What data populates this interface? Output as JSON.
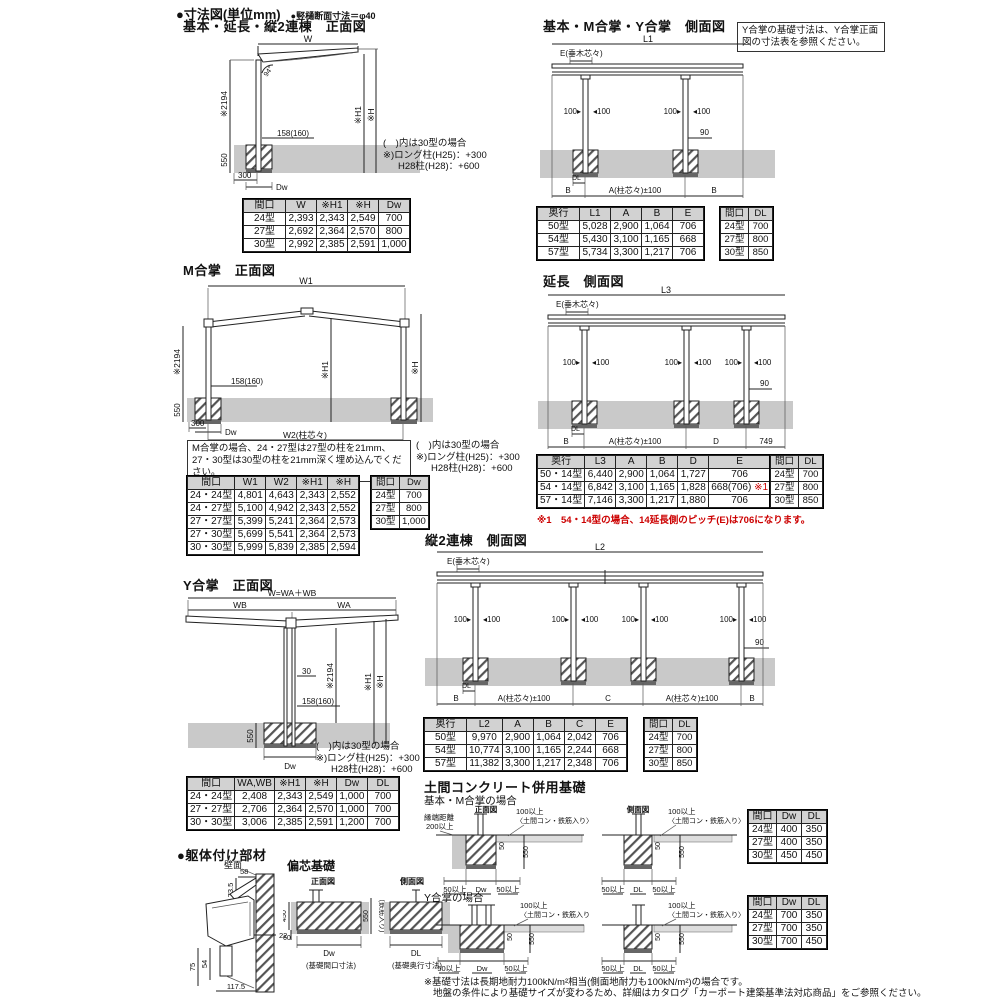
{
  "header": {
    "title": "●寸法図(単位mm)",
    "subtitle": "●竪樋断面寸法＝φ40"
  },
  "common_notes": {
    "l1": "(　)内は30型の場合",
    "l2": "※)ロング柱(H25)：+300",
    "l3": "H28柱(H28)：+600"
  },
  "side_dims": {
    "pl": "100▸",
    "pr": "◂100"
  },
  "front_basic": {
    "title": "基本・延長・縦2連棟　正面図",
    "dims": {
      "w": "W",
      "v2194": "※2194",
      "h1": "※H1",
      "h": "※H",
      "embed": "158(160)",
      "d550": "550",
      "d300": "300",
      "dw": "Dw",
      "angle": "94°"
    },
    "table": {
      "headers": [
        "間口",
        "W",
        "※H1",
        "※H",
        "Dw"
      ],
      "rows": [
        [
          "24型",
          "2,393",
          "2,343",
          "2,549",
          "700"
        ],
        [
          "27型",
          "2,692",
          "2,364",
          "2,570",
          "800"
        ],
        [
          "30型",
          "2,992",
          "2,385",
          "2,591",
          "1,000"
        ]
      ]
    }
  },
  "m_gassho": {
    "title": "M合掌　正面図",
    "note_box": "M合掌の場合、24・27型は27型の柱を21mm、27・30型は30型の柱を21mm深く埋め込んでください。",
    "dims": {
      "w1": "W1",
      "w2": "W2(柱芯々)",
      "v2194": "※2194",
      "h1": "※H1",
      "h": "※H",
      "embed": "158(160)",
      "d550": "550",
      "d300": "300",
      "dw": "Dw"
    },
    "table": {
      "headers": [
        "間口",
        "W1",
        "W2",
        "※H1",
        "※H"
      ],
      "rows": [
        [
          "24・24型",
          "4,801",
          "4,643",
          "2,343",
          "2,552"
        ],
        [
          "24・27型",
          "5,100",
          "4,942",
          "2,343",
          "2,552"
        ],
        [
          "27・27型",
          "5,399",
          "5,241",
          "2,364",
          "2,573"
        ],
        [
          "27・30型",
          "5,699",
          "5,541",
          "2,364",
          "2,573"
        ],
        [
          "30・30型",
          "5,999",
          "5,839",
          "2,385",
          "2,594"
        ]
      ]
    },
    "side_table": {
      "headers": [
        "間口",
        "Dw"
      ],
      "rows": [
        [
          "24型",
          "700"
        ],
        [
          "27型",
          "800"
        ],
        [
          "30型",
          "1,000"
        ]
      ]
    }
  },
  "y_gassho": {
    "title": "Y合掌　正面図",
    "dims": {
      "w": "W=WA＋WB",
      "wb": "WB",
      "wa": "WA",
      "n30": "30",
      "v2194": "※2194",
      "h1": "※H1",
      "h": "※H",
      "embed": "158(160)",
      "d550": "550",
      "dw": "Dw"
    },
    "table": {
      "headers": [
        "間口",
        "WA,WB",
        "※H1",
        "※H",
        "Dw",
        "DL"
      ],
      "rows": [
        [
          "24・24型",
          "2,408",
          "2,343",
          "2,549",
          "1,000",
          "700"
        ],
        [
          "27・27型",
          "2,706",
          "2,364",
          "2,570",
          "1,000",
          "700"
        ],
        [
          "30・30型",
          "3,006",
          "2,385",
          "2,591",
          "1,200",
          "700"
        ]
      ]
    }
  },
  "side_basic": {
    "title": "基本・M合掌・Y合掌　側面図",
    "note_box": "Y合掌の基礎寸法は、Y合掌正面図の寸法表を参照ください。",
    "dims": {
      "l1": "L1",
      "e": "E(垂木芯々)",
      "n90": "90",
      "dl": "DL",
      "b": "B",
      "a": "A(柱芯々)±100"
    },
    "table": {
      "headers": [
        "奥行",
        "L1",
        "A",
        "B",
        "E"
      ],
      "rows": [
        [
          "50型",
          "5,028",
          "2,900",
          "1,064",
          "706"
        ],
        [
          "54型",
          "5,430",
          "3,100",
          "1,165",
          "668"
        ],
        [
          "57型",
          "5,734",
          "3,300",
          "1,217",
          "706"
        ]
      ]
    },
    "side_table": {
      "headers": [
        "間口",
        "DL"
      ],
      "rows": [
        [
          "24型",
          "700"
        ],
        [
          "27型",
          "800"
        ],
        [
          "30型",
          "850"
        ]
      ]
    }
  },
  "side_ext": {
    "title": "延長　側面図",
    "dims": {
      "l3": "L3",
      "e": "E(垂木芯々)",
      "n90": "90",
      "dl": "DL",
      "b": "B",
      "a": "A(柱芯々)±100",
      "d": "D",
      "n749": "749"
    },
    "table": {
      "headers": [
        "奥行",
        "L3",
        "A",
        "B",
        "D",
        "E"
      ],
      "rows": [
        [
          "50・14型",
          "6,440",
          "2,900",
          "1,064",
          "1,727",
          "706"
        ],
        [
          "54・14型",
          "6,842",
          "3,100",
          "1,165",
          "1,828",
          "668(706) ※1"
        ],
        [
          "57・14型",
          "7,146",
          "3,300",
          "1,217",
          "1,880",
          "706"
        ]
      ]
    },
    "side_table": {
      "headers": [
        "間口",
        "DL"
      ],
      "rows": [
        [
          "24型",
          "700"
        ],
        [
          "27型",
          "800"
        ],
        [
          "30型",
          "850"
        ]
      ]
    },
    "red_note": "※1　54・14型の場合、14延長側のピッチ(E)は706になります。"
  },
  "side_2ren": {
    "title": "縦2連棟　側面図",
    "dims": {
      "l2": "L2",
      "e": "E(垂木芯々)",
      "n90": "90",
      "dl": "DL",
      "b": "B",
      "a": "A(柱芯々)±100",
      "c": "C"
    },
    "table": {
      "headers": [
        "奥行",
        "L2",
        "A",
        "B",
        "C",
        "E"
      ],
      "rows": [
        [
          "50型",
          "9,970",
          "2,900",
          "1,064",
          "2,042",
          "706"
        ],
        [
          "54型",
          "10,774",
          "3,100",
          "1,165",
          "2,244",
          "668"
        ],
        [
          "57型",
          "11,382",
          "3,300",
          "1,217",
          "2,348",
          "706"
        ]
      ]
    },
    "side_table": {
      "headers": [
        "間口",
        "DL"
      ],
      "rows": [
        [
          "24型",
          "700"
        ],
        [
          "27型",
          "800"
        ],
        [
          "30型",
          "850"
        ]
      ]
    }
  },
  "doma": {
    "title": "土間コンクリート併用基礎",
    "case_basic": "基本・M合掌の場合",
    "case_y": "Y合掌の場合",
    "front_label": "正面図",
    "side_label": "側面図",
    "edge1": "縁端距離",
    "edge2": "200以上",
    "over100": "100以上",
    "rebar": "〈土間コン・鉄筋入り〉",
    "d50": "50",
    "d550": "550",
    "min50": "50以上",
    "dw": "Dw",
    "dl": "DL",
    "table_basic": {
      "headers": [
        "間口",
        "Dw",
        "DL"
      ],
      "rows": [
        [
          "24型",
          "400",
          "350"
        ],
        [
          "27型",
          "400",
          "350"
        ],
        [
          "30型",
          "450",
          "450"
        ]
      ]
    },
    "table_y": {
      "headers": [
        "間口",
        "Dw",
        "DL"
      ],
      "rows": [
        [
          "24型",
          "700",
          "350"
        ],
        [
          "27型",
          "700",
          "350"
        ],
        [
          "30型",
          "700",
          "450"
        ]
      ]
    }
  },
  "kutai": {
    "title": "●躯体付け部材",
    "wall_label": "壁面",
    "dims": {
      "d58": "58",
      "d735": "73.5",
      "d22": "22",
      "d75": "75",
      "d54": "54",
      "d1175": "117.5"
    }
  },
  "henshin": {
    "title": "偏芯基礎",
    "front_label": "正面図",
    "side_label": "側面図",
    "d450": "450",
    "d60": "60",
    "d550": "550",
    "vert_note": "(鉄筋入り)",
    "dw_label": "Dw",
    "dw_caption": "(基礎間口寸法)",
    "dl_label": "DL",
    "dl_caption": "(基礎奥行寸法)"
  },
  "footer_note": {
    "line1": "※基礎寸法は長期地耐力100kN/m²相当(側面地耐力も100kN/m²)の場合です。",
    "line2": "地盤の条件により基礎サイズが変わるため、詳細はカタログ「カーポート建築基準法対応商品」をご参照ください。"
  }
}
